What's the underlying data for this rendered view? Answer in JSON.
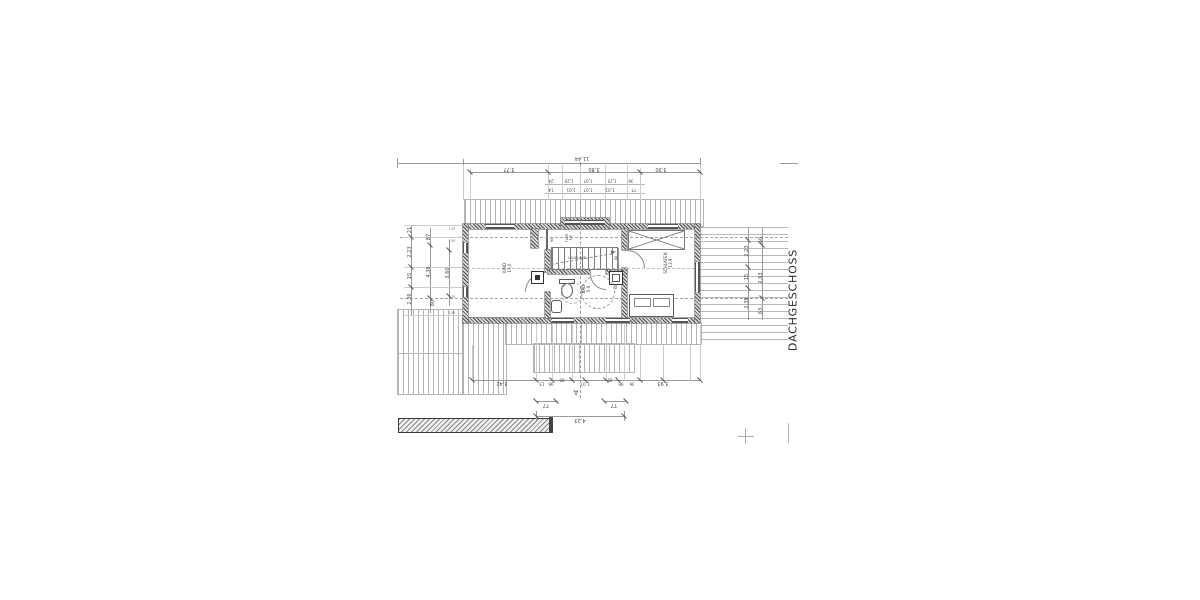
{
  "floor_title": "DACHGESCHOSS",
  "rooms": [
    {
      "id": "kind",
      "label": "KIND\n13,0"
    },
    {
      "id": "schlafen",
      "label": "SCHLAFEN\n13,9"
    },
    {
      "id": "bad",
      "label": "BAD\n5,9"
    },
    {
      "id": "flur",
      "label": "FLUR\n3,8"
    }
  ],
  "dim_labels": [
    {
      "t": "11,44",
      "x": 582,
      "y": 157,
      "r": 180,
      "s": 5
    },
    {
      "t": "3,77",
      "x": 509,
      "y": 168,
      "r": 180,
      "s": 5
    },
    {
      "t": "3,80",
      "x": 594,
      "y": 168,
      "r": 180,
      "s": 5
    },
    {
      "t": "3,30",
      "x": 661,
      "y": 168,
      "r": 180,
      "s": 5
    },
    {
      "t": "24",
      "x": 551,
      "y": 180,
      "r": 180,
      "s": 4
    },
    {
      "t": "1,25",
      "x": 569,
      "y": 180,
      "r": 180,
      "s": 4
    },
    {
      "t": "1,07",
      "x": 588,
      "y": 180,
      "r": 180,
      "s": 4
    },
    {
      "t": "1,25",
      "x": 612,
      "y": 180,
      "r": 180,
      "s": 4
    },
    {
      "t": "36",
      "x": 631,
      "y": 180,
      "r": 180,
      "s": 4
    },
    {
      "t": "14",
      "x": 551,
      "y": 189,
      "r": 180,
      "s": 4
    },
    {
      "t": "1,01",
      "x": 571,
      "y": 189,
      "r": 180,
      "s": 4
    },
    {
      "t": "1,07",
      "x": 588,
      "y": 189,
      "r": 180,
      "s": 4
    },
    {
      "t": "1,01",
      "x": 610,
      "y": 189,
      "r": 180,
      "s": 4
    },
    {
      "t": "77",
      "x": 634,
      "y": 189,
      "r": 180,
      "s": 4
    },
    {
      "t": "21",
      "x": 411,
      "y": 230,
      "r": -90,
      "s": 5
    },
    {
      "t": "2,23",
      "x": 411,
      "y": 252,
      "r": -90,
      "s": 5
    },
    {
      "t": "15",
      "x": 411,
      "y": 276,
      "r": -90,
      "s": 5
    },
    {
      "t": "2,36",
      "x": 411,
      "y": 299,
      "r": -90,
      "s": 5
    },
    {
      "t": "87",
      "x": 430,
      "y": 237,
      "r": -90,
      "s": 5
    },
    {
      "t": "4,38",
      "x": 430,
      "y": 272,
      "r": -90,
      "s": 5
    },
    {
      "t": "80",
      "x": 434,
      "y": 303,
      "r": -90,
      "s": 5
    },
    {
      "t": "3,60",
      "x": 449,
      "y": 273,
      "r": -90,
      "s": 5
    },
    {
      "t": "2,23",
      "x": 748,
      "y": 251,
      "r": -90,
      "s": 5
    },
    {
      "t": "15",
      "x": 748,
      "y": 277,
      "r": -90,
      "s": 5
    },
    {
      "t": "2,38",
      "x": 748,
      "y": 303,
      "r": -90,
      "s": 5
    },
    {
      "t": "60",
      "x": 762,
      "y": 240,
      "r": -90,
      "s": 5
    },
    {
      "t": "2,63",
      "x": 762,
      "y": 278,
      "r": -90,
      "s": 5
    },
    {
      "t": "63",
      "x": 762,
      "y": 311,
      "r": -90,
      "s": 5
    },
    {
      "t": "3,42",
      "x": 502,
      "y": 382,
      "r": 180,
      "s": 5
    },
    {
      "t": "13",
      "x": 542,
      "y": 383,
      "r": 180,
      "s": 4
    },
    {
      "t": "96",
      "x": 551,
      "y": 383,
      "r": 180,
      "s": 4
    },
    {
      "t": "89",
      "x": 562,
      "y": 379,
      "r": 180,
      "s": 4
    },
    {
      "t": "1,07",
      "x": 585,
      "y": 383,
      "r": 180,
      "s": 4
    },
    {
      "t": "89",
      "x": 610,
      "y": 379,
      "r": 180,
      "s": 4
    },
    {
      "t": "96",
      "x": 621,
      "y": 383,
      "r": 180,
      "s": 4
    },
    {
      "t": "36",
      "x": 632,
      "y": 383,
      "r": 180,
      "s": 4
    },
    {
      "t": "3,93",
      "x": 663,
      "y": 382,
      "r": 180,
      "s": 5
    },
    {
      "t": "77",
      "x": 546,
      "y": 404,
      "r": 180,
      "s": 5
    },
    {
      "t": "77",
      "x": 614,
      "y": 404,
      "r": 180,
      "s": 5
    },
    {
      "t": "4,23",
      "x": 580,
      "y": 419,
      "r": 180,
      "s": 5
    },
    {
      "t": "A",
      "x": 576,
      "y": 392,
      "r": 180,
      "s": 7
    }
  ],
  "annotations": [
    {
      "t": "LAUFLINIE",
      "x": 577,
      "y": 258,
      "r": 0,
      "s": 3.5
    },
    {
      "t": "90",
      "x": 552,
      "y": 240,
      "r": -90,
      "s": 3.5
    },
    {
      "t": "80",
      "x": 616,
      "y": 258,
      "r": -90,
      "s": 3.5
    },
    {
      "t": "80",
      "x": 616,
      "y": 287,
      "r": -90,
      "s": 3.5
    },
    {
      "t": "1,50",
      "x": 452,
      "y": 229,
      "r": 0,
      "s": 3
    },
    {
      "t": "1,50",
      "x": 452,
      "y": 241,
      "r": 0,
      "s": 3
    },
    {
      "t": "1,50",
      "x": 452,
      "y": 297,
      "r": 0,
      "s": 3
    },
    {
      "t": "1,50",
      "x": 452,
      "y": 313,
      "r": 0,
      "s": 3
    }
  ]
}
